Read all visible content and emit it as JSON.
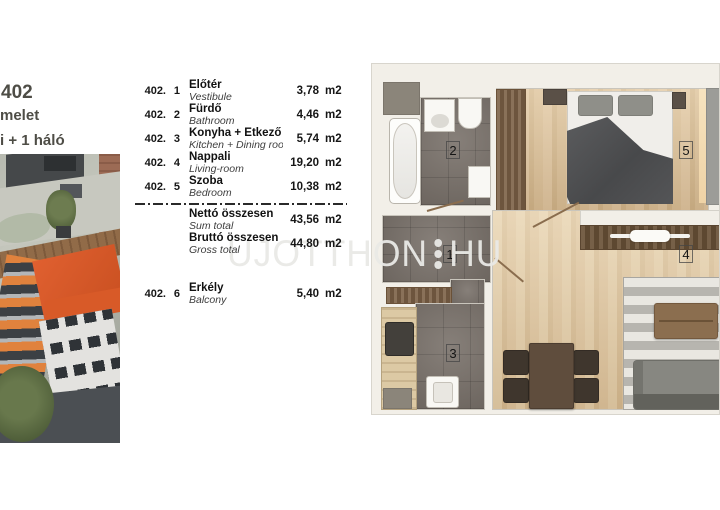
{
  "header": {
    "line1": "402",
    "line2": "melet",
    "line3": "i + 1 háló"
  },
  "table": {
    "rows": [
      {
        "unit": "402.",
        "idx": "1",
        "name_hu": "Előtér",
        "name_en": "Vestibule",
        "area": "3,78",
        "m2": "m2"
      },
      {
        "unit": "402.",
        "idx": "2",
        "name_hu": "Fürdő",
        "name_en": "Bathroom",
        "area": "4,46",
        "m2": "m2"
      },
      {
        "unit": "402.",
        "idx": "3",
        "name_hu": "Konyha + Étkező",
        "name_en": "Kitchen + Dining room",
        "area": "5,74",
        "m2": "m2"
      },
      {
        "unit": "402.",
        "idx": "4",
        "name_hu": "Nappali",
        "name_en": "Living-room",
        "area": "19,20",
        "m2": "m2"
      },
      {
        "unit": "402.",
        "idx": "5",
        "name_hu": "Szoba",
        "name_en": "Bedroom",
        "area": "10,38",
        "m2": "m2"
      }
    ],
    "totals": [
      {
        "name_hu": "Nettó összesen",
        "name_en": "Sum total",
        "area": "43,56",
        "m2": "m2"
      },
      {
        "name_hu": "Bruttó összesen",
        "name_en": "Gross total",
        "area": "44,80",
        "m2": "m2"
      }
    ],
    "extra": {
      "unit": "402.",
      "idx": "6",
      "name_hu": "Erkély",
      "name_en": "Balcony",
      "area": "5,40",
      "m2": "m2"
    }
  },
  "watermark": {
    "left": "UJOTTHON",
    "right": "HU"
  },
  "plan": {
    "labels": {
      "r1": "1",
      "r2": "2",
      "r3": "3",
      "r4": "4",
      "r5": "5"
    }
  },
  "colors": {
    "accent_orange": "#d85a28",
    "watermark_gray": "#e9e9e6",
    "tile_floor": "#79716a",
    "wood_floor": "#d8bd96",
    "wall": "#f2efe8",
    "header_text": "#4e4d46"
  }
}
